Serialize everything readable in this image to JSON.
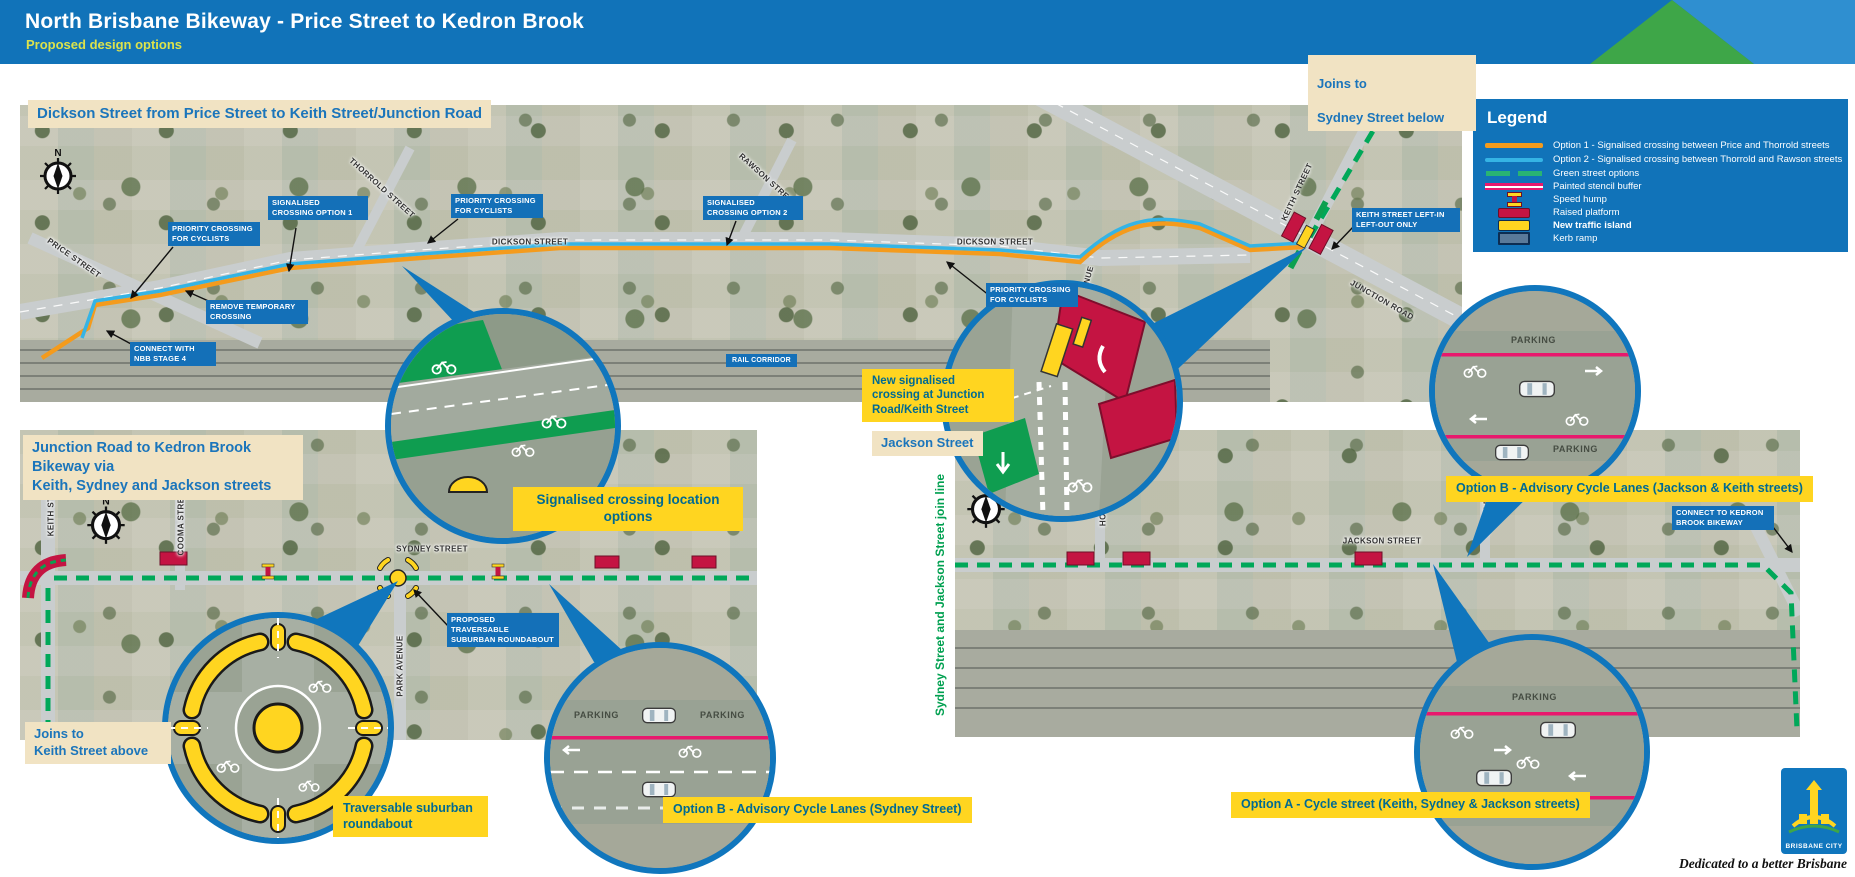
{
  "header": {
    "title": "North Brisbane Bikeway - Price Street to Kedron Brook",
    "subtitle": "Proposed design options"
  },
  "legend": {
    "title": "Legend",
    "items": [
      {
        "label": "Option 1 - Signalised crossing between Price and Thorrold streets",
        "swatch": "orange-line"
      },
      {
        "label": "Option 2 - Signalised crossing between Thorrold and Rawson streets",
        "swatch": "blue-line"
      },
      {
        "label": "Green street options",
        "swatch": "green-dashed"
      },
      {
        "label": "Painted stencil buffer",
        "swatch": "pink-double-line"
      },
      {
        "label": "Speed hump",
        "swatch": "speed-hump-icon"
      },
      {
        "label": "Raised platform",
        "swatch": "crimson-rect"
      },
      {
        "label": "New traffic island",
        "swatch": "yellow-rect"
      },
      {
        "label": "Kerb ramp",
        "swatch": "kerb-ramp-icon"
      }
    ]
  },
  "top_map": {
    "title": "Dickson Street from Price Street to Keith Street/Junction Road",
    "joins_line1": "Joins to",
    "joins_line2": "Sydney Street below",
    "streets": {
      "price": "PRICE STREET",
      "thorrold": "THORROLD STREET",
      "rawson": "RAWSON STREET",
      "dickson": "DICKSON STREET",
      "keith": "KEITH STREET",
      "junction": "JUNCTION ROAD",
      "binney": "BINNEY AVENUE",
      "rail": "RAIL CORRIDOR"
    },
    "callouts": {
      "priority": "PRIORITY CROSSING\nFOR CYCLISTS",
      "signalised1": "SIGNALISED\nCROSSING OPTION 1",
      "signalised2": "SIGNALISED\nCROSSING OPTION 2",
      "remove": "REMOVE TEMPORARY\nCROSSING",
      "connect_nbb": "CONNECT WITH\nNBB STAGE 4",
      "keith_leftin": "KEITH STREET LEFT-IN\nLEFT-OUT ONLY"
    },
    "highlight_signalised": "New signalised crossing at Junction Road/Keith Street",
    "highlight_location": "Signalised crossing location options"
  },
  "bottom_left_map": {
    "title_line1": "Junction Road to Kedron Brook Bikeway via",
    "title_line2": "Keith, Sydney and Jackson streets",
    "streets": {
      "keith": "KEITH STREET",
      "cooma": "COOMA STREET",
      "sydney": "SYDNEY STREET",
      "park": "PARK AVENUE"
    },
    "callouts": {
      "roundabout": "PROPOSED TRAVERSABLE\nSUBURBAN ROUNDABOUT"
    },
    "joins_line1": "Joins to",
    "joins_line2": "Keith Street above",
    "inset_roundabout_label": "Traversable suburban roundabout",
    "inset_optionb_label": "Option B - Advisory Cycle Lanes (Sydney Street)"
  },
  "bottom_right_map": {
    "title": "Jackson Street",
    "join_note": "Sydney Street and Jackson Street join line",
    "streets": {
      "home": "HOME STREET",
      "kemble": "KEMBLE STREET",
      "jackson": "JACKSON STREET"
    },
    "callouts": {
      "connect_kedron": "CONNECT TO KEDRON\nBROOK BIKEWAY"
    },
    "inset_optionb_label": "Option B - Advisory Cycle Lanes (Jackson & Keith streets)",
    "inset_optiona_label": "Option A - Cycle street (Keith, Sydney & Jackson streets)"
  },
  "shared": {
    "parking": "PARKING",
    "compass_n": "N"
  },
  "footer": {
    "tagline": "Dedicated to a better Brisbane",
    "logo_text": "BRISBANE CITY"
  },
  "colors": {
    "header_blue": "#1173b9",
    "option1_orange": "#f49b1d",
    "option2_blue": "#35b4e5",
    "green_street": "#00a859",
    "painted_buffer_pink": "#e8186d",
    "raised_platform_crimson": "#c41442",
    "traffic_island_yellow": "#ffd520",
    "callout_blue": "#1470b8",
    "cream": "#f1e3c3"
  }
}
